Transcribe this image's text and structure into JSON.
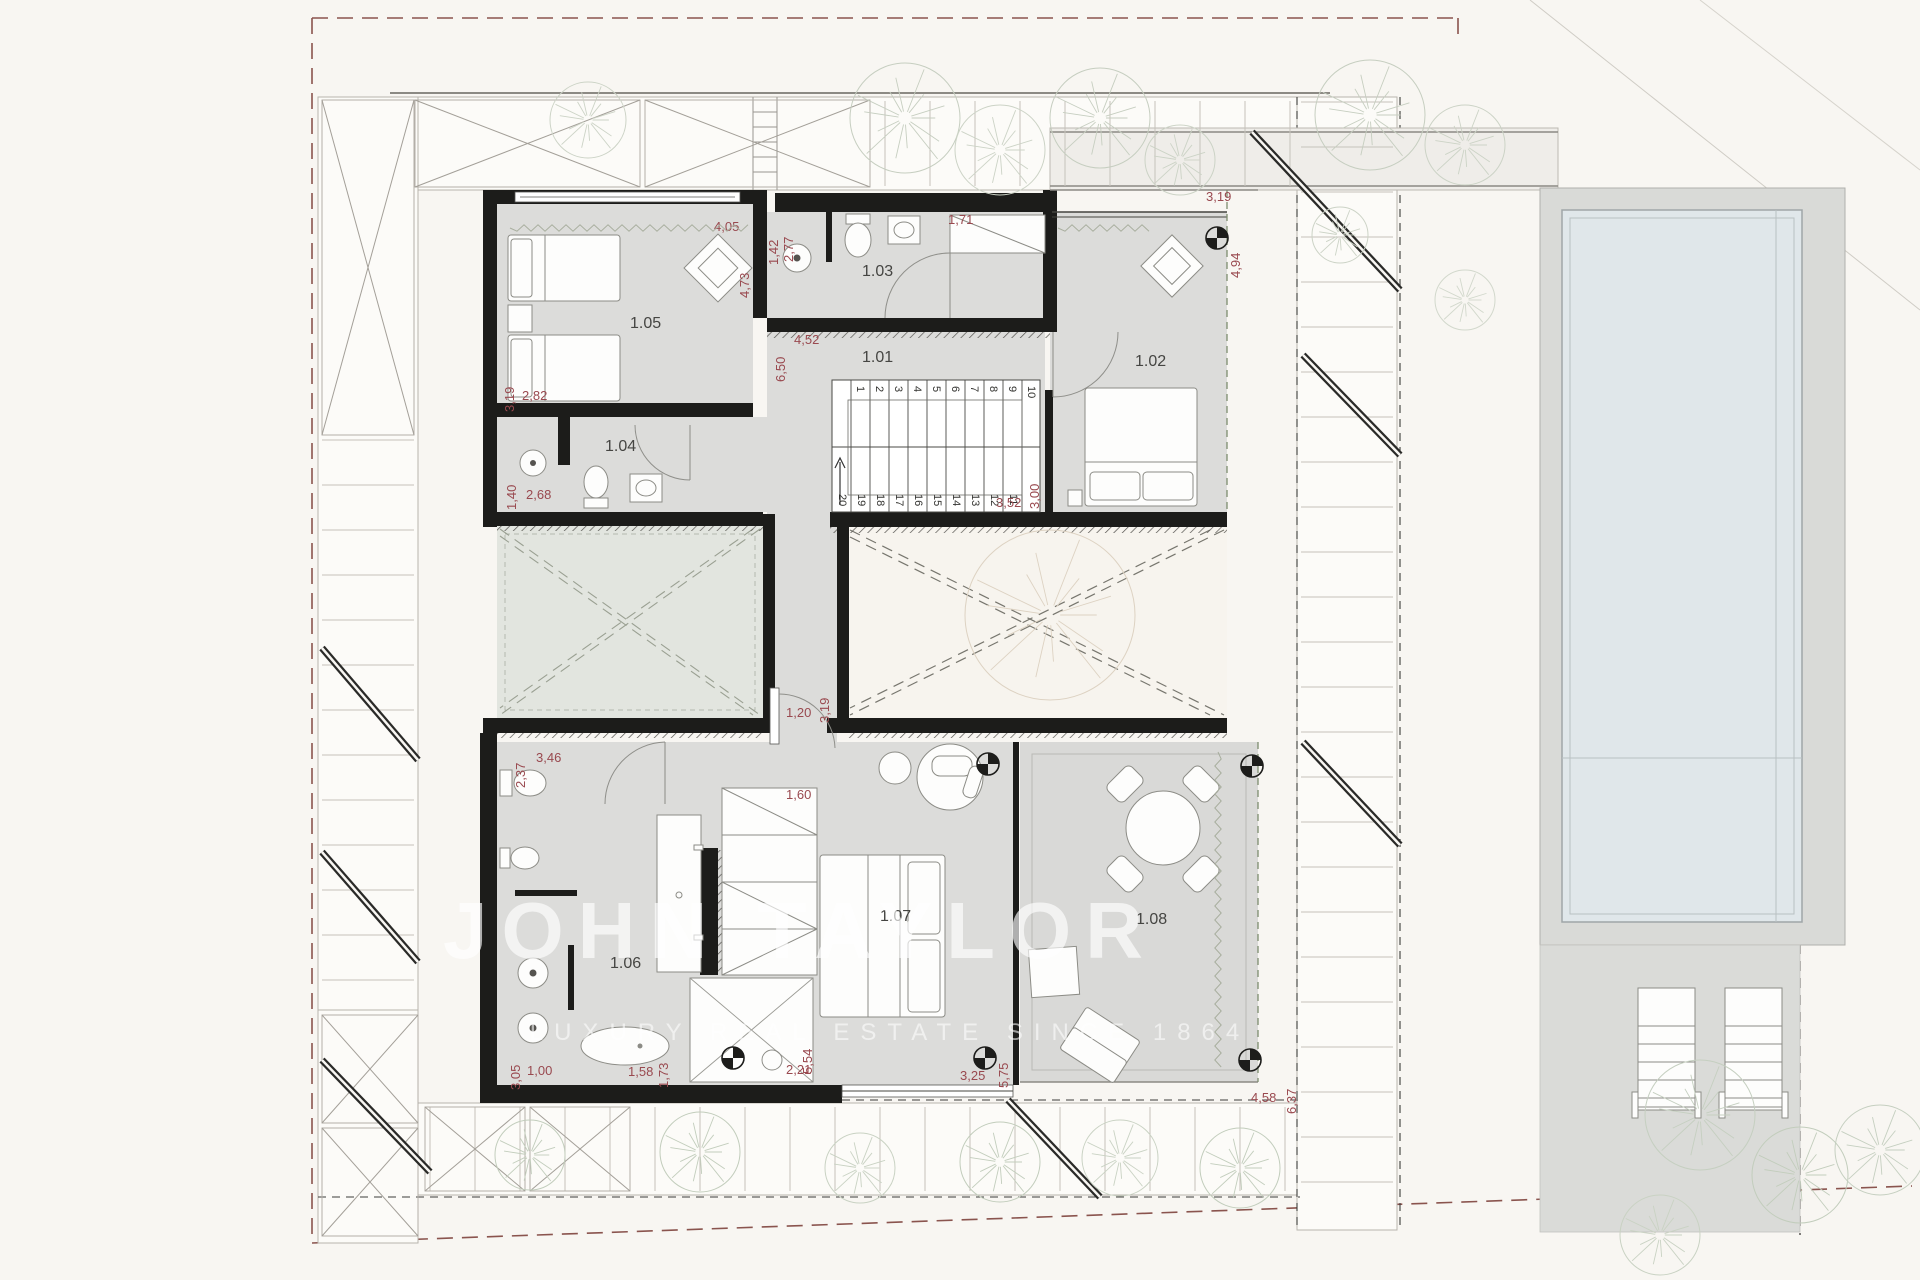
{
  "watermark": {
    "brand": "JOHN TAYLOR",
    "tagline": "LUXURY REAL ESTATE SINCE 1864"
  },
  "rooms": {
    "r101": "1.01",
    "r102": "1.02",
    "r103": "1.03",
    "r104": "1.04",
    "r105": "1.05",
    "r106": "1.06",
    "r107": "1.07",
    "r108": "1.08"
  },
  "dims": [
    "4,05",
    "4,73",
    "2,77",
    "1,42",
    "1,71",
    "3,19",
    "4,94",
    "6,50",
    "4,52",
    "3,19",
    "2,82",
    "1,40",
    "2,68",
    "3,52",
    "3,00",
    "1,20",
    "3,19",
    "2,37",
    "3,46",
    "1,60",
    "3,05",
    "1,00",
    "1,58",
    "1,73",
    "2,21",
    "5,54",
    "3,25",
    "5,75",
    "4,58",
    "6,37"
  ],
  "stairs": {
    "up": [
      "1",
      "2",
      "3",
      "4",
      "5",
      "6",
      "7",
      "8",
      "9",
      "10"
    ],
    "down": [
      "20",
      "19",
      "18",
      "17",
      "16",
      "15",
      "14",
      "13",
      "12",
      "11"
    ]
  },
  "icons": {
    "survey_marker": "circle-cross",
    "tree": "radial-tree-sketch"
  }
}
